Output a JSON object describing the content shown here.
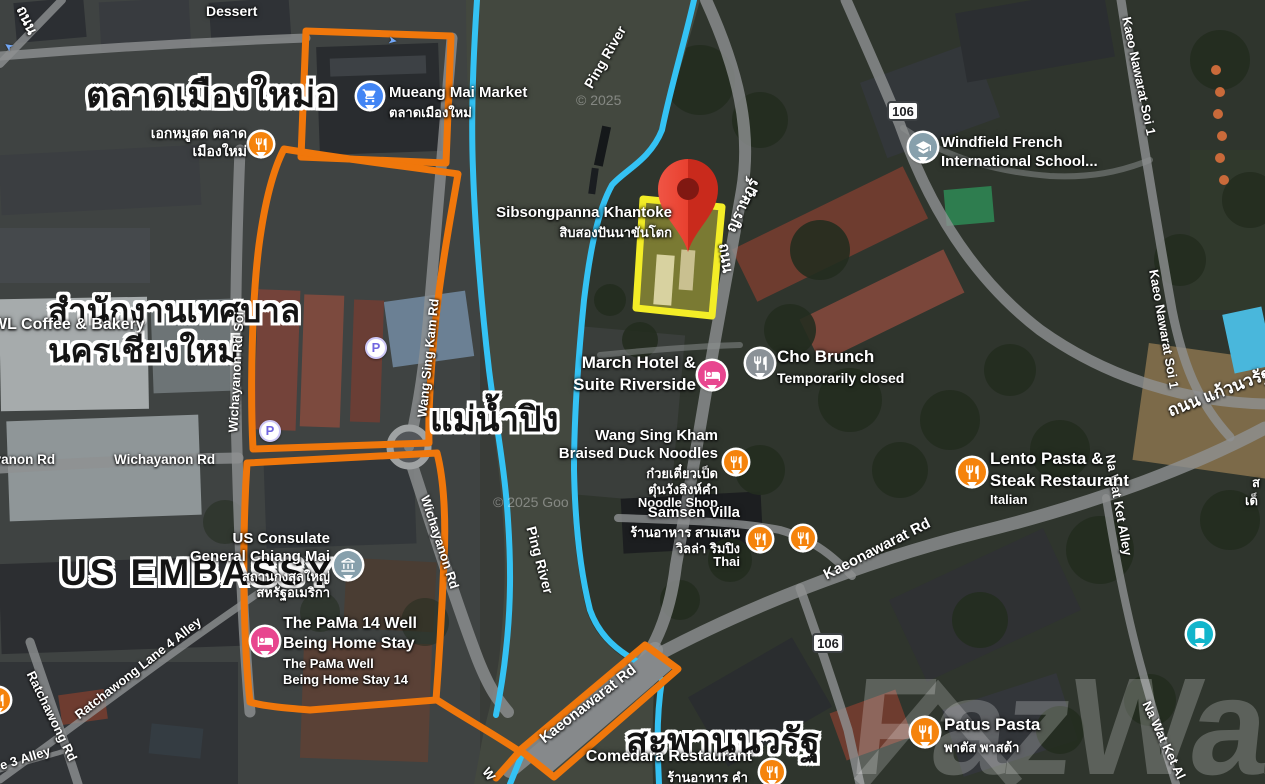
{
  "colors": {
    "route_highlight_orange": "#F0770B",
    "river_outline_blue": "#34C2F4",
    "plot_highlight_yellow": "#F3ED27",
    "pin_red": "#E8402F",
    "poi_orange": "#F5830C",
    "poi_blue": "#4285F4",
    "poi_pink": "#E8468F",
    "poi_gray": "#8A9197",
    "poi_grayblue": "#87A0AC",
    "poi_teal": "#12B5CB"
  },
  "watermark": {
    "brand": "FazWaz",
    "copyright_top": "© 2025",
    "copyright_mid": "© 2025 Goo"
  },
  "annotations": {
    "market_big": "ตลาดเมืองใหม่อ",
    "municipality1": "สำนักงานเทศบาล",
    "municipality2": "นครเชียงใหม่",
    "river_big": "แม่น้ำปิง",
    "embassy_big": "US EMBASSY",
    "bridge_big": "สะพานนวรัฐ"
  },
  "shield": {
    "route": "106"
  },
  "roads": {
    "thanon": "ถนน",
    "ping_river": "Ping River",
    "wichayanon_soi": "Wichayanon Rd Soi",
    "wang_sing_kam": "Wang Sing Kam Rd",
    "wichayanon": "Wichayanon Rd",
    "ratchawong_lane4": "Ratchawong Lane 4 Alley",
    "ratchawong_rd": "Ratchawong Rd",
    "lane3_partial": "e 3 Alley",
    "kaeonawarat": "Kaeonawarat Rd",
    "na_wat_ket": "Na Wat Ket Alley",
    "na_wat_ket_partial": "Na Wat Ket Al",
    "kaeo_soi1": "Kaeo Nawarat Soi 1",
    "kaeo_thai": "ถนน แก้วนวรัฐ",
    "charoen_partial": "ญราษฎร์",
    "w_partial": "W"
  },
  "places": {
    "dessert": {
      "name": "Dessert"
    },
    "mueang_market": {
      "name": "Mueang Mai Market",
      "thai": "ตลาดเมืองใหม่"
    },
    "ek_mu_sot": {
      "line1": "เอกหมูสด ตลาด",
      "line2": "เมืองใหม่"
    },
    "wl_coffee": {
      "name": "WL Coffee & Bakery"
    },
    "sibsongpanna": {
      "name": "Sibsongpanna Khantoke",
      "thai": "สิบสองปันนาขันโตก"
    },
    "march_hotel": {
      "line1": "March Hotel &",
      "line2": "Suite Riverside"
    },
    "cho_brunch": {
      "name": "Cho Brunch",
      "status": "Temporarily closed"
    },
    "windfield": {
      "line1": "Windfield French",
      "line2": "International School..."
    },
    "wang_sing_kham": {
      "line1": "Wang Sing Kham",
      "line2": "Braised Duck Noodles",
      "thai1": "ก๋วยเตี๋ยวเป็ด",
      "thai2": "ตุ๋นวังสิงห์คำ",
      "category": "Noodle Shop"
    },
    "samsen_villa": {
      "name": "Samsen Villa",
      "thai1": "ร้านอาหาร สามเสน",
      "thai2": "วิลล่า ริมปิง",
      "category": "Thai"
    },
    "lento": {
      "line1": "Lento Pasta &",
      "line2": "Steak Restaurant",
      "category": "Italian"
    },
    "us_consulate": {
      "line1": "US Consulate",
      "line2": "General Chiang Mai",
      "thai1": "สถานกงสุลใหญ่",
      "thai2": "สหรัฐอเมริกา"
    },
    "pama": {
      "line1": "The PaMa 14 Well",
      "line2": "Being Home Stay",
      "sub1": "The PaMa Well",
      "sub2": "Being Home Stay 14"
    },
    "comedara": {
      "name": "Comedara Restaurant",
      "thai": "ร้านอาหาร คำ"
    },
    "patus": {
      "name": "Patus Pasta",
      "thai": "พาตัส พาสต้า"
    },
    "edge_fragment1": "ส",
    "edge_fragment2": "เด็"
  },
  "parking_label": "P"
}
